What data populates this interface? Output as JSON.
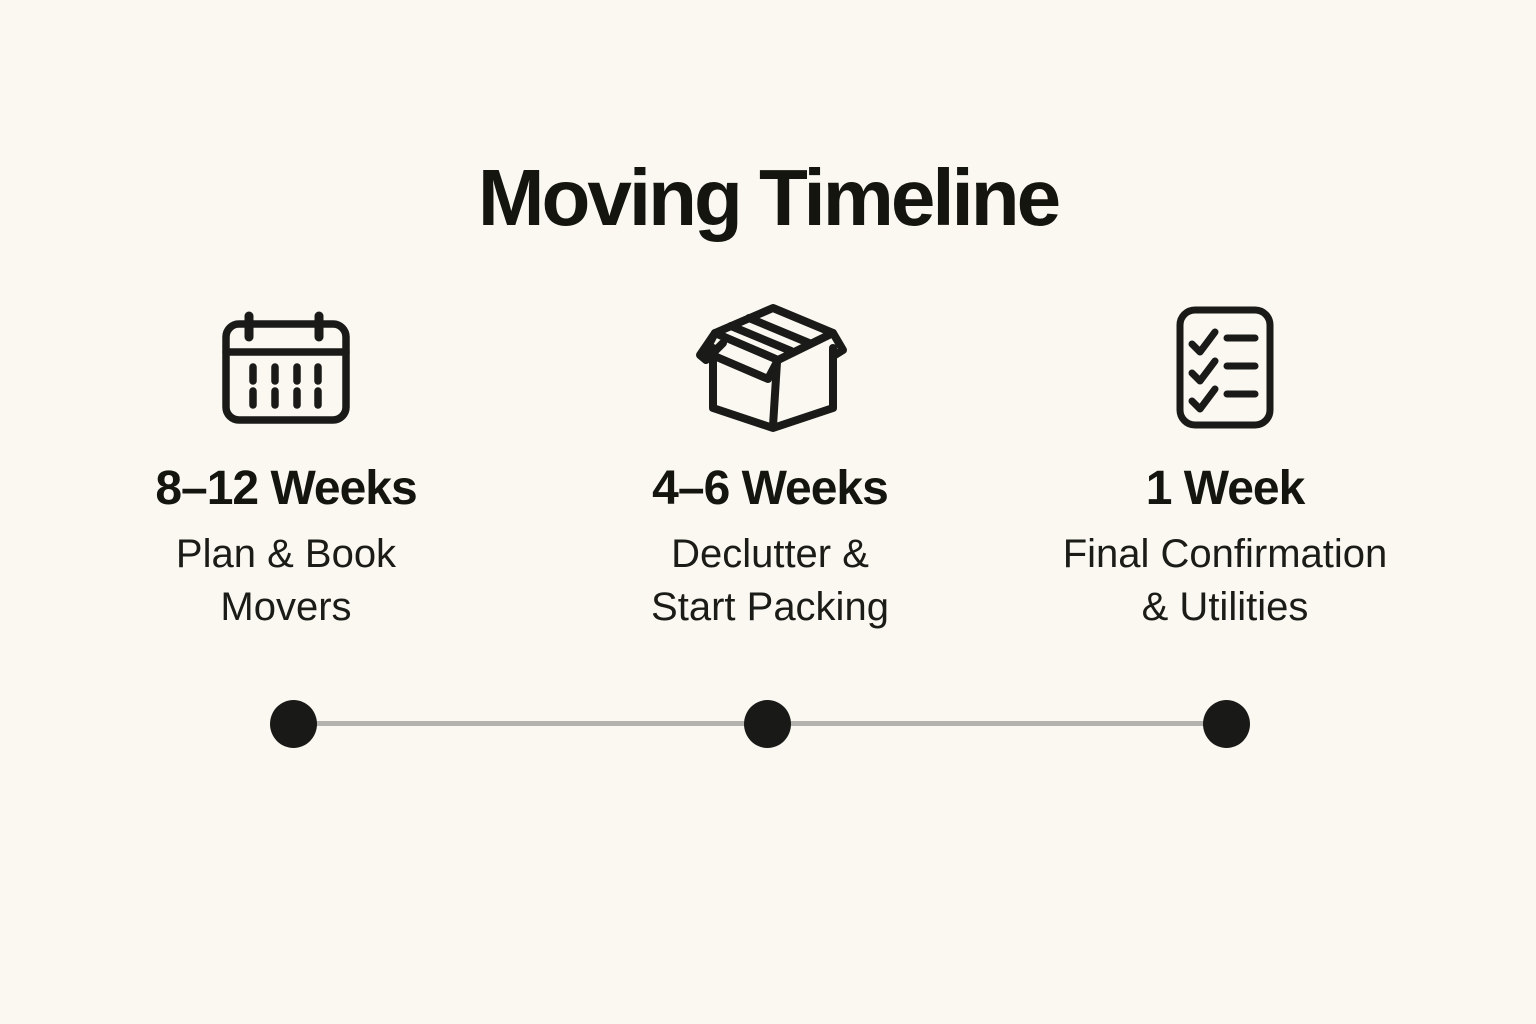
{
  "page": {
    "title": "Moving Timeline",
    "colors": {
      "background": "#faf8f1",
      "ink": "#191915",
      "timeline_line": "#b3b2af",
      "timeline_dot": "#191917"
    }
  },
  "steps": [
    {
      "icon": "calendar-icon",
      "timeframe": "8–12 Weeks",
      "task_lines": [
        "Plan & Book",
        "Movers"
      ]
    },
    {
      "icon": "moving-box-icon",
      "timeframe": "4–6 Weeks",
      "task_lines": [
        "Declutter &",
        "Start Packing"
      ]
    },
    {
      "icon": "checklist-icon",
      "timeframe": "1 Week",
      "task_lines": [
        "Final Confirmation",
        "& Utilities"
      ]
    }
  ],
  "timeline": {
    "dot_count": 3
  }
}
